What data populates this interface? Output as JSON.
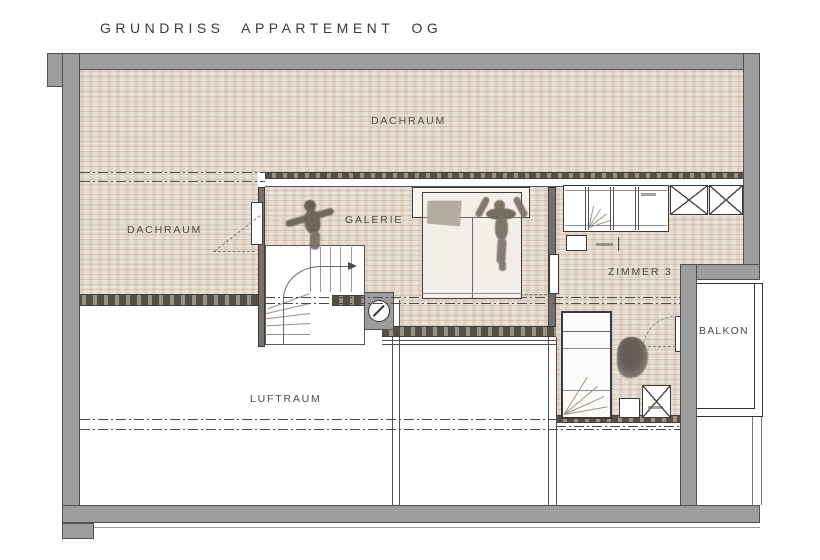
{
  "title": "GRUNDRISS APPARTEMENT OG",
  "rooms": {
    "dachraum_top": "DACHRAUM",
    "dachraum_left": "DACHRAUM",
    "galerie": "GALERIE",
    "zimmer_3": "ZIMMER 3",
    "luftraum": "LUFTRAUM",
    "balkon": "BALKON"
  },
  "symbols": {
    "column_symbol": "circle-with-diagonal",
    "stair_direction": "arrow-up-the-stairs",
    "shaft_marker": "crossed-box"
  },
  "colors": {
    "wall": "#9d9d9d",
    "wall_outline": "#515151",
    "attic_floor_hatch": "#e8ded2",
    "dark_band": "#9a9083",
    "line": "#4b4b4b",
    "label_text": "#4e4a44",
    "background": "#ffffff"
  }
}
